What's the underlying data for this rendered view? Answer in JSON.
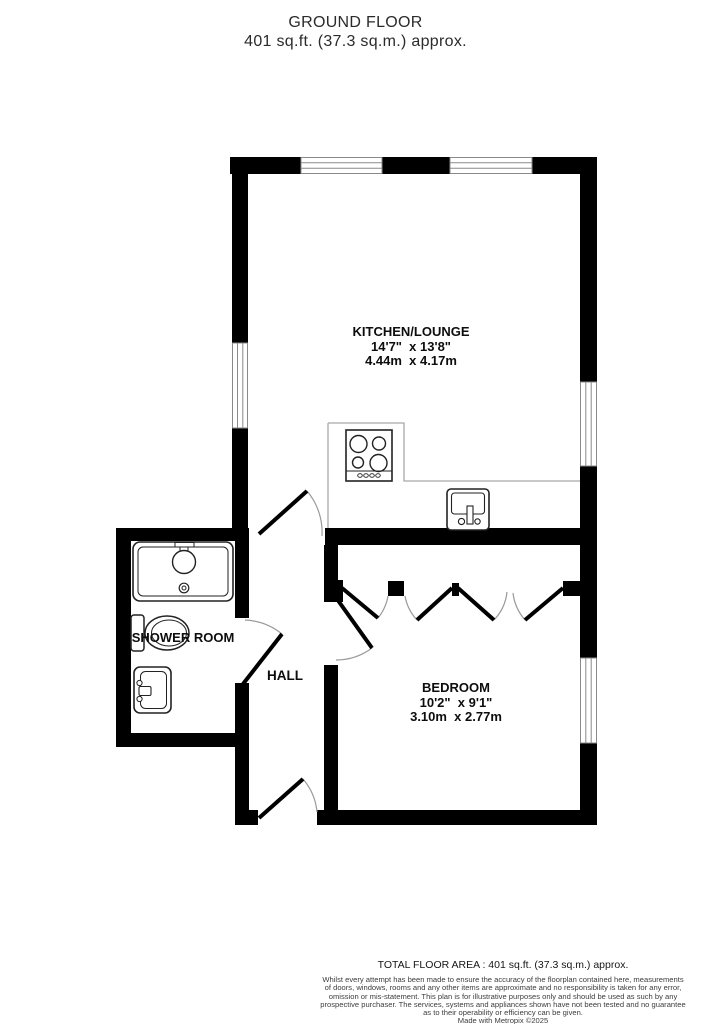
{
  "title": {
    "line1": "GROUND FLOOR",
    "line2": "401 sq.ft. (37.3 sq.m.) approx."
  },
  "rooms": {
    "kitchen": {
      "name": "KITCHEN/LOUNGE",
      "imperial": "14'7\"  x 13'8\"",
      "metric": "4.44m  x 4.17m"
    },
    "bedroom": {
      "name": "BEDROOM",
      "imperial": "10'2\"  x 9'1\"",
      "metric": "3.10m  x 2.77m"
    },
    "shower_room": {
      "name": "SHOWER ROOM"
    },
    "hall": {
      "name": "HALL"
    }
  },
  "fixtures": [
    "stove-icon",
    "kitchen-sink-icon",
    "shower-icon",
    "toilet-icon",
    "basin-icon"
  ],
  "footer": {
    "total": "TOTAL FLOOR AREA : 401 sq.ft. (37.3 sq.m.) approx.",
    "disclaimer": "Whilst every attempt has been made to ensure the accuracy of the floorplan contained here, measurements\nof doors, windows, rooms and any other items are approximate and no responsibility is taken for any error,\nomission or mis-statement. This plan is for illustrative purposes only and should be used as such by any\nprospective purchaser. The services, systems and appliances shown have not been tested and no guarantee\nas to their operability or efficiency can be given.",
    "credit": "Made with Metropix ©2025"
  },
  "colors": {
    "wall": "#000000",
    "fixture_outline": "#222222",
    "window_line": "#8a8a8a",
    "door_arc": "#9a9a9a",
    "counter_line": "#a8a8a8",
    "text": "#0d0d0d"
  }
}
